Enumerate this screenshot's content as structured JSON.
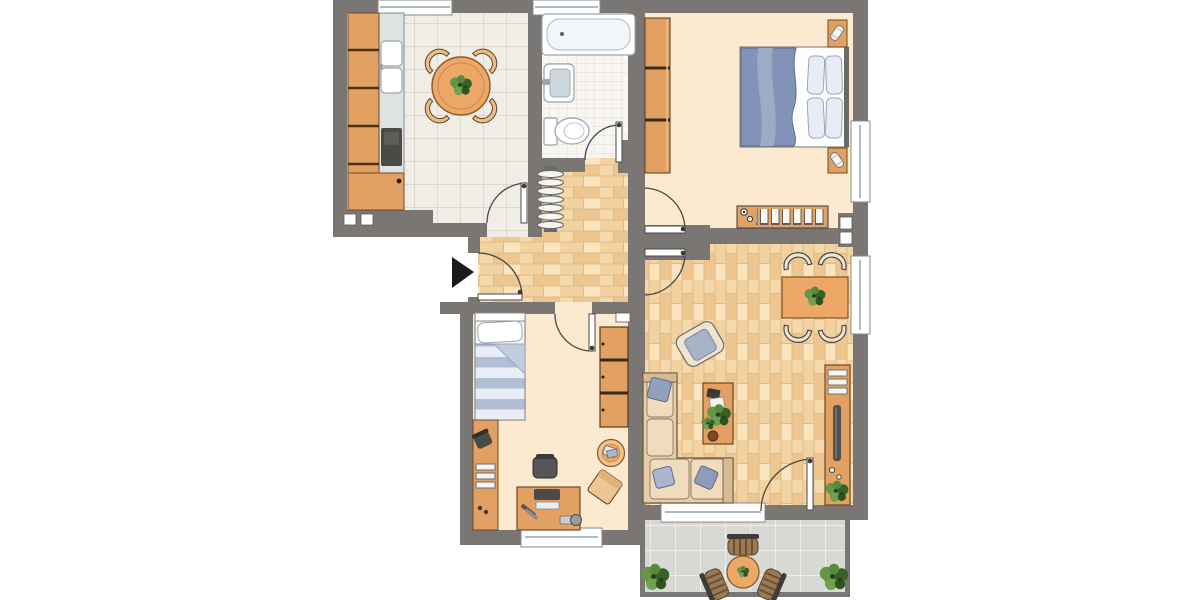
{
  "image_type": "apartment-floor-plan",
  "visible_text": [],
  "palette": {
    "background": "#ffffff",
    "wall": "#7a7673",
    "wood_furniture": "#e2a162",
    "wood_furniture_light": "#edbd85",
    "wood_outline": "#6b4a26",
    "parquet_base": "#dfba8a",
    "parquet_plank_light": "#f9e4bd",
    "parquet_plank_mid": "#f2d2a0",
    "parquet_plank_dark": "#edc78f",
    "room_floor_cream": "#fbe9d0",
    "kitchen_tile": "#f0ede6",
    "bath_tile": "#f8f6f1",
    "balcony_tile": "#d8d8d4",
    "textile_blue": "#8193b6",
    "pillow_blue": "#93a0bd",
    "sofa_tan": "#e7cda8",
    "white_fixture": "#ffffff",
    "plant_green": "#4a7a36",
    "arrow_black": "#1a1a1a"
  },
  "marker": {
    "entrance_arrow": "black triangle pointing right into hallway"
  },
  "rooms": [
    {
      "name": "kitchen",
      "floor": "large square tiles",
      "furniture": [
        "kitchen-cabinet-row",
        "double-sink",
        "stove",
        "corner-cabinet",
        "round-dining-table",
        "4 chairs",
        "table-plant"
      ]
    },
    {
      "name": "bathroom",
      "floor": "small square tiles",
      "furniture": [
        "bathtub",
        "wash-basin",
        "toilet"
      ]
    },
    {
      "name": "bedroom",
      "floor": "cream",
      "furniture": [
        "wardrobe-3-sections",
        "double-bed",
        "blue-duvet",
        "4 pillows",
        "2 nightstands",
        "2 lamps",
        "radiator"
      ]
    },
    {
      "name": "hallway",
      "floor": "parquet",
      "furniture": [
        "coat-rack-with-hangers",
        "entrance-arrow"
      ]
    },
    {
      "name": "childrens-room",
      "floor": "cream",
      "furniture": [
        "single-bed-striped-duvet",
        "wall-shelf-unit",
        "desk",
        "office-chair",
        "monitor",
        "keyboard",
        "wardrobe-3-sections",
        "round-side-table",
        "floor-cushion"
      ]
    },
    {
      "name": "living-room",
      "floor": "parquet",
      "furniture": [
        "corner-sofa",
        "3 cushions",
        "armchair",
        "coffee-table",
        "dining-table",
        "4 chairs",
        "sideboard-with-tv",
        "plant"
      ]
    },
    {
      "name": "balcony",
      "floor": "grey tiles",
      "furniture": [
        "bistro-table",
        "3 wicker-chairs",
        "2 shrubs"
      ]
    }
  ],
  "openings": {
    "windows": 8,
    "doors": [
      "entrance-door",
      "kitchen-door",
      "bathroom-door",
      "bedroom-door",
      "living-room-door",
      "childrens-room-door",
      "balcony-door"
    ]
  }
}
